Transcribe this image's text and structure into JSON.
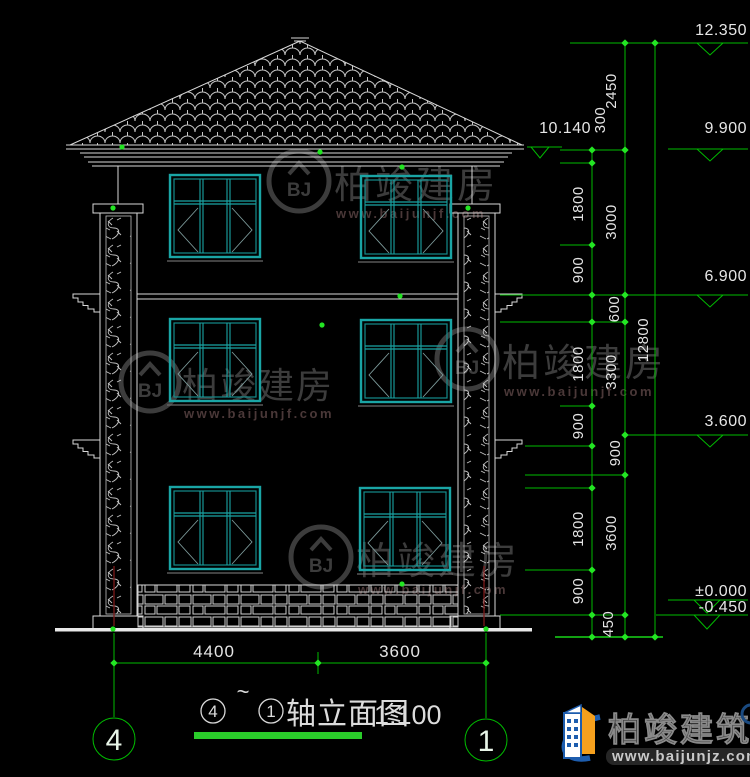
{
  "drawing": {
    "title_name": "轴立面图",
    "title_scale": "1:100",
    "title_tilde": "~",
    "axis_start": "4",
    "axis_end": "1"
  },
  "elevations": {
    "ridge": "12.350",
    "eave_left": "10.140",
    "f3_top": "9.900",
    "f2_top": "6.900",
    "f1_top": "3.600",
    "zero": "±0.000",
    "base": "-0.450"
  },
  "dims": {
    "right_inner": [
      "300",
      "1800",
      "900",
      "1800",
      "900",
      "1800",
      "900"
    ],
    "right_mid": [
      "2450",
      "3000",
      "600",
      "3300",
      "900",
      "3600",
      "450"
    ],
    "right_total": "12800",
    "bottom": [
      "4400",
      "3600"
    ]
  },
  "watermark": {
    "name": "柏竣建房",
    "url": "www.baijunjf.com",
    "monogram": "BJ"
  },
  "logo": {
    "name": "柏竣建筑",
    "url": "www.baijunjz.com"
  },
  "colors": {
    "background": "#000000",
    "line_white": "#d9d9d9",
    "dimension_green": "#00bc00",
    "grip_green": "#23e523",
    "window_teal": "#1aa5a5",
    "grid_red": "#7c1a1a",
    "logo_blue": "#1d5dae",
    "logo_orange": "#f5a01d",
    "underline_green": "#2acc2a"
  }
}
